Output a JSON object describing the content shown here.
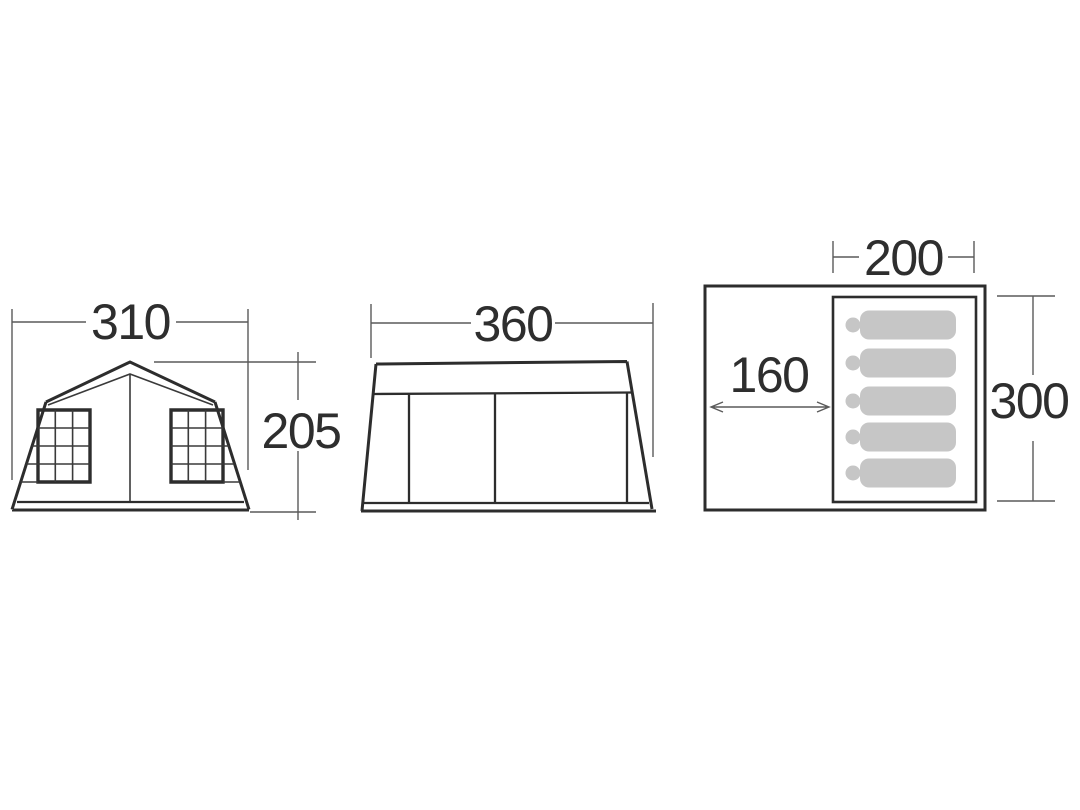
{
  "figures": {
    "front_view": {
      "name": "front-elevation",
      "width_cm": "310",
      "height_cm": "205"
    },
    "side_view": {
      "name": "side-elevation",
      "width_cm": "360"
    },
    "floor_plan": {
      "name": "floor-plan",
      "inner_room_width_cm": "200",
      "front_area_depth_cm": "160",
      "depth_cm": "300",
      "sleeper_count": 5
    }
  },
  "colors": {
    "line": "#2d2d2d",
    "dimension_line": "#5a5a5a",
    "sleeping_bag": "#c6c6c6",
    "background": "#ffffff"
  }
}
